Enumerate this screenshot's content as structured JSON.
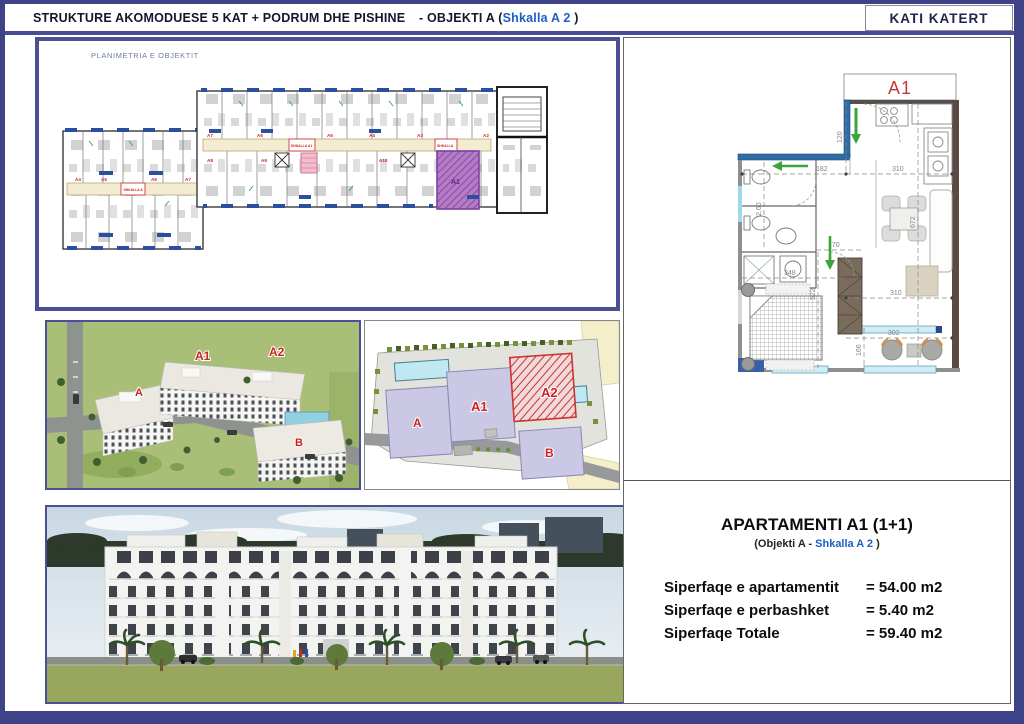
{
  "header": {
    "title": "STRUKTURE AKOMODUESE 5 KAT + PODRUM DHE PISHINE",
    "objekti": "-  OBJEKTI A (",
    "shkalla": "Shkalla A 2",
    "close_paren": " )",
    "floor_box": "KATI KATERT"
  },
  "floorplan": {
    "caption": "PLANIMETRIA E OBJEKTIT",
    "left_units": [
      "A4",
      "A5",
      "A6",
      "A7"
    ],
    "right_units_top": [
      "A7",
      "A6",
      "A5",
      "A4",
      "A3",
      "A2"
    ],
    "right_units_bottom": [
      "A8",
      "A9",
      "A10"
    ],
    "stair_left": "SHKALLA A",
    "stair_right": "SHKALLA A1",
    "stair_right2": "SHKALLA",
    "highlight_unit": "A1"
  },
  "aerial_view": {
    "labels": {
      "a": "A",
      "a1": "A1",
      "a2": "A2",
      "b": "B"
    }
  },
  "site_plan": {
    "labels": {
      "a": "A",
      "a1": "A1",
      "a2": "A2",
      "b": "B"
    }
  },
  "apartment_plan": {
    "unit": "A1",
    "dims": [
      "182",
      "310",
      "120",
      "2,60",
      "672",
      "170",
      "348",
      "522",
      "310",
      "302",
      "166"
    ]
  },
  "details": {
    "title": "APARTAMENTI A1 (1+1)",
    "subtitle_pre": "(Objekti A - ",
    "subtitle_accent": "Shkalla A 2",
    "subtitle_post": " )",
    "rows": [
      {
        "label": "Siperfaqe e apartamentit",
        "value": "= 54.00 m2"
      },
      {
        "label": "Siperfaqe e perbashket",
        "value": "=  5.40 m2"
      },
      {
        "label": "Siperfaqe Totale",
        "value": "= 59.40 m2"
      }
    ]
  },
  "colors": {
    "frame_navy": "#3e4287",
    "accent_blue": "#1d5fc2",
    "label_red": "#cc2222",
    "highlight_purple": "#a86fc0",
    "block_lavender": "#cbc8e6",
    "hatch_red": "#cc3333",
    "pool_cyan": "#b9e6f0",
    "lawn_green": "#99a65e",
    "sky_blue": "#d9e3ea"
  }
}
